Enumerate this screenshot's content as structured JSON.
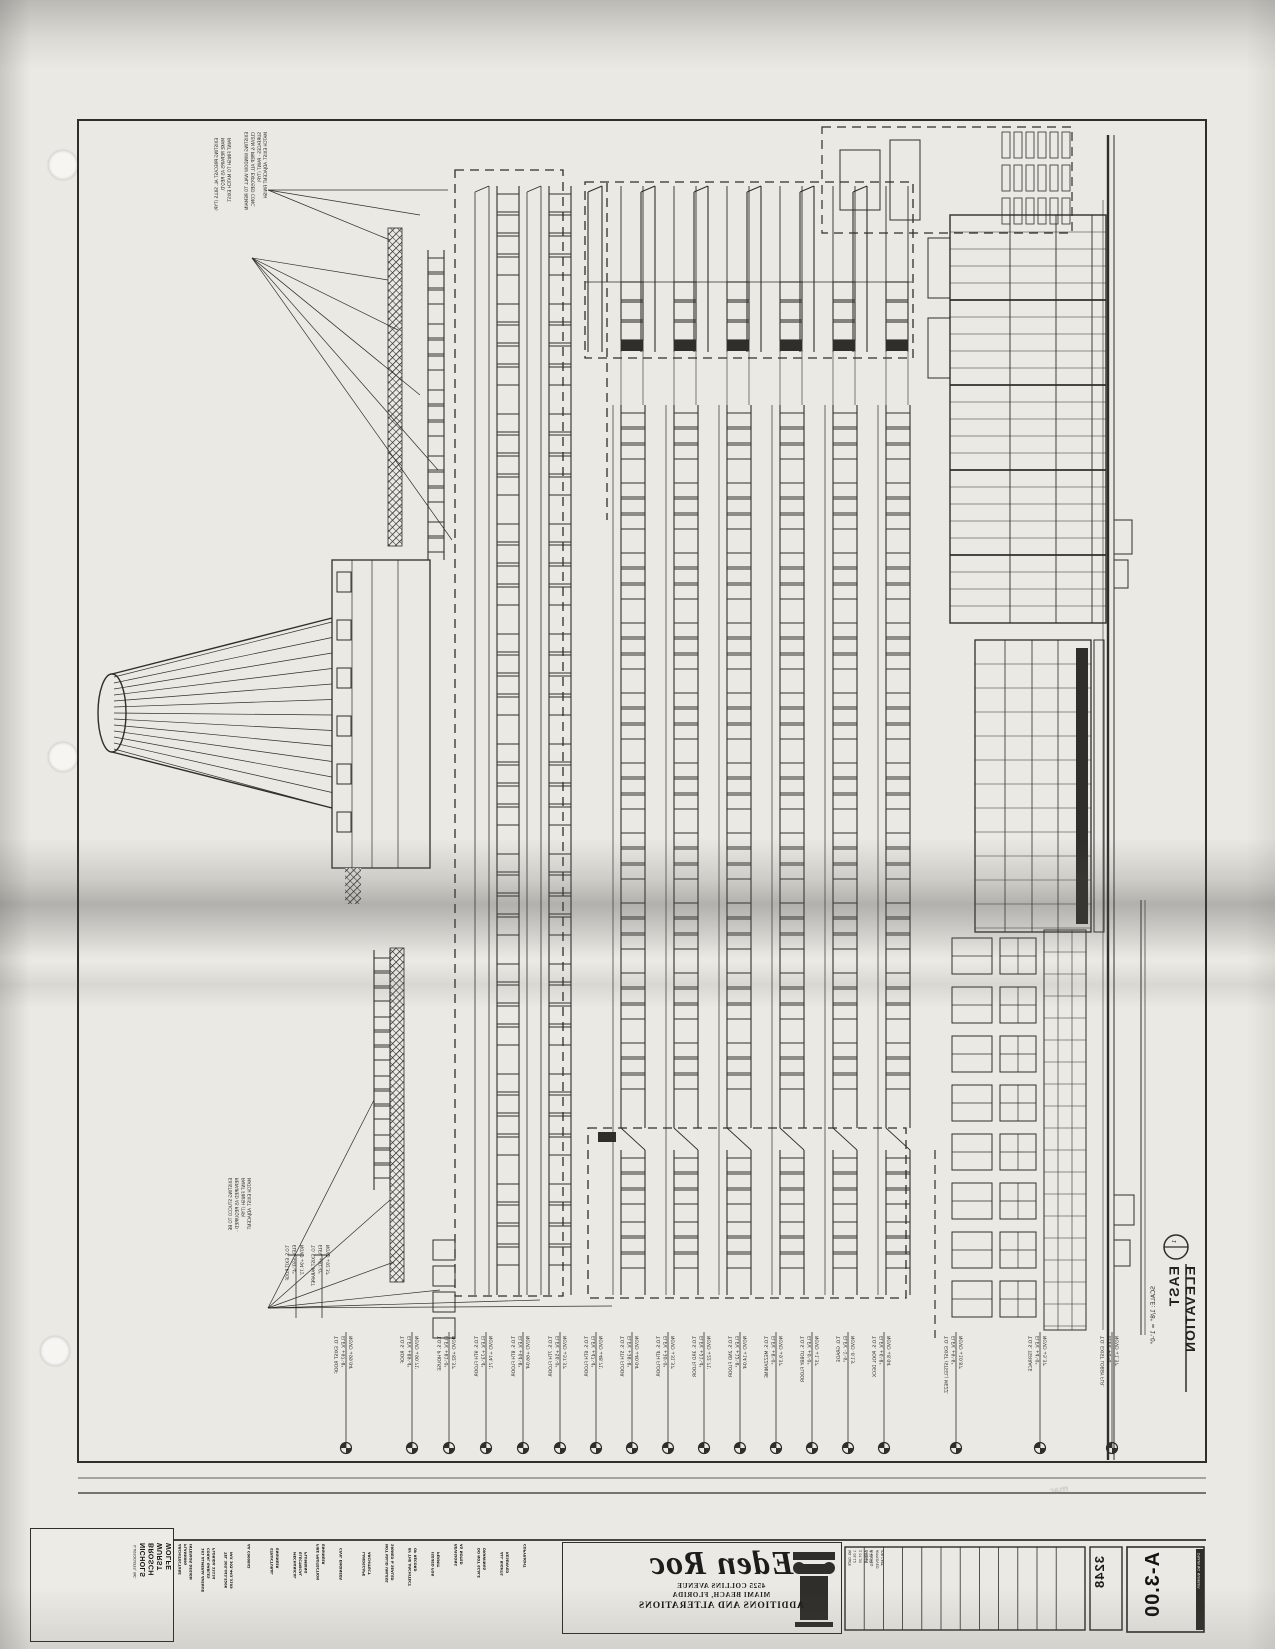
{
  "page": {
    "bg": "#ebe9e4",
    "ink": "#2f2e2b"
  },
  "drawing": {
    "title": "EAST ELEVATION",
    "scale": "SCALE: 1/8\" = 1'-0\"",
    "elevation_mark": {
      "number": "1",
      "sheet": "A3.0"
    },
    "levels": [
      {
        "x": 346,
        "lines": "T.O. EXIST ROOF\nELEV. +97'-8\"\nNGVD +99.04'"
      },
      {
        "x": 412,
        "lines": "T.O.S. ROOF\nELEV. +89'-4\"\nNGVD +90.71'"
      },
      {
        "x": 449,
        "lines": "T.O.S. P'HOUSE\nELEV. +81'-0\"\nNGVD +82.37'"
      },
      {
        "x": 486,
        "lines": "T.O.S. 9TH FLOOR\nELEV. +73'-4\"\nNGVD +74.71'"
      },
      {
        "x": 523,
        "lines": "T.O.S. 8TH FLOOR\nELEV. +64'-8\"\nNGVD +66.04'"
      },
      {
        "x": 560,
        "lines": "T.O.S. 7TH FLOOR\nELEV. +56'-0\"\nNGVD +57.37'"
      },
      {
        "x": 596,
        "lines": "T.O.S. 6TH FLOOR\nELEV. +47'-4\"\nNGVD +48.71'"
      },
      {
        "x": 632,
        "lines": "T.O.S. 5TH FLOOR\nELEV. +38'-8\"\nNGVD +40.04'"
      },
      {
        "x": 668,
        "lines": "T.O.S. 4TH FLOOR\nELEV. +30'-0\"\nNGVD +31.37'"
      },
      {
        "x": 704,
        "lines": "T.O.S. 3RD FLOOR\nELEV. +21'-4\"\nNGVD +22.71'"
      },
      {
        "x": 740,
        "lines": "T.O.S. 2ND FLOOR\nELEV. +12'-8\"\nNGVD +14.04'"
      },
      {
        "x": 776,
        "lines": "T.O.S. MEZZANINE\nELEV. +8'-0\"\nNGVD +9.37'"
      },
      {
        "x": 812,
        "lines": "T.O.S. LOBBY FLOOR\nELEV. +0'-0\"\nNGVD +1.37'"
      },
      {
        "x": 848,
        "lines": "T.O. GRADE\nELEV. -1'-6\"\nNGVD -0.13'"
      },
      {
        "x": 884,
        "lines": "T.O.S. POOL DECK\nELEV. +6'-8\"\nNGVD +8.04'"
      },
      {
        "x": 956,
        "lines": "T.O. EXIST (STEEL) MEZZ.\nELEV. +9'-6\"\nNGVD +10.87'"
      },
      {
        "x": 1040,
        "lines": "T.O.S. TERRACE\nELEV. +4'-0\"\nNGVD +5.37'"
      },
      {
        "x": 1112,
        "lines": "T.O. EXIST LOBBY FLR.\nELEV. +0'-0\"\nNGVD +1.37'"
      }
    ],
    "aux_levels": [
      {
        "x": 296,
        "lines": "T.O.S. EXIT ROOF\nELEV. +93'-4\"\nNGVD +94.71'"
      },
      {
        "x": 322,
        "lines": "T.O. EXIST PARAPET\nELEV. +91'-0\"\nNGVD +92.37'"
      }
    ],
    "notes_top": [
      {
        "x": 214,
        "y": 138,
        "lines": "EXISTING PRECAST AL. SILLS (TYP)\nMAKE REPAIRS AS REQ'D.\nPAINT FINISH TO MATCH EXIST."
      },
      {
        "x": 244,
        "y": 132,
        "lines": "EXISTING WINDOW WALL TO REMAIN\nCLEAN & PREP ALL EXPOSED CONC.\nSURFACES - PAINT (TYP)\nMATCH EXIST. ADJACENT FINISH"
      }
    ],
    "notes_bottom": [
      {
        "x": 228,
        "y": 1178,
        "lines": "EXISTING STUCCO TO BE\nREPAIRED AS REQUIRED -\nPAINT FINISH (TYP)\nMATCH EXIST. ADJACENT"
      }
    ]
  },
  "title_block": {
    "firm": {
      "logo_letter": "N",
      "logo_sub": "o",
      "name_lines": "NICHOLS\nBROSCH\nWURST\nWOLFE",
      "assoc": "& ASSOCIATES, INC."
    },
    "consultant_columns": [
      "ARCHITECTURE\nPLANNING\nINTERIOR DESIGN",
      "161 ALMERIA AVENUE\nCORAL GABLES\nFLORIDA 33134",
      "TEL 305.443.5206\nFAX 305.443.3109",
      "AA C000842",
      "STRUCTURAL\nENGINEER",
      "MECHANICAL\nELECTRICAL\nPLUMBING",
      "FIRE PROTECTION\nENGINEER",
      "CIVIL ENGINEER",
      "LANDSCAPE\nARCHITECT",
      "NOT VALID UNLESS\nSIGNED & SEALED",
      "BY THE ARCHITECT\nOF RECORD",
      "ISSUED FOR\nPERMIT",
      "REVISIONS\nAS NOTED",
      "DO NOT SCALE\nDRAWINGS",
      "ALL RIGHTS\nRESERVED",
      "COPYRIGHT"
    ],
    "project": {
      "brand": "Eden Roc",
      "address1": "4525 COLLINS AVENUE",
      "address2": "MIAMI BEACH, FLORIDA",
      "subtitle": "ADDITIONS AND ALTERATIONS"
    },
    "revision_columns": [
      "NO.  DATE\n1   05.12\n2   07.30\n3   09.18\n4   11.02",
      "DRAWN\nCHECKED\nAPPROVED\nJOB CAPT."
    ],
    "job_number": "3248",
    "sheet_number": "A-3.00",
    "sheet_label": "DRAWING NUMBER"
  },
  "smudge_text": "mar"
}
